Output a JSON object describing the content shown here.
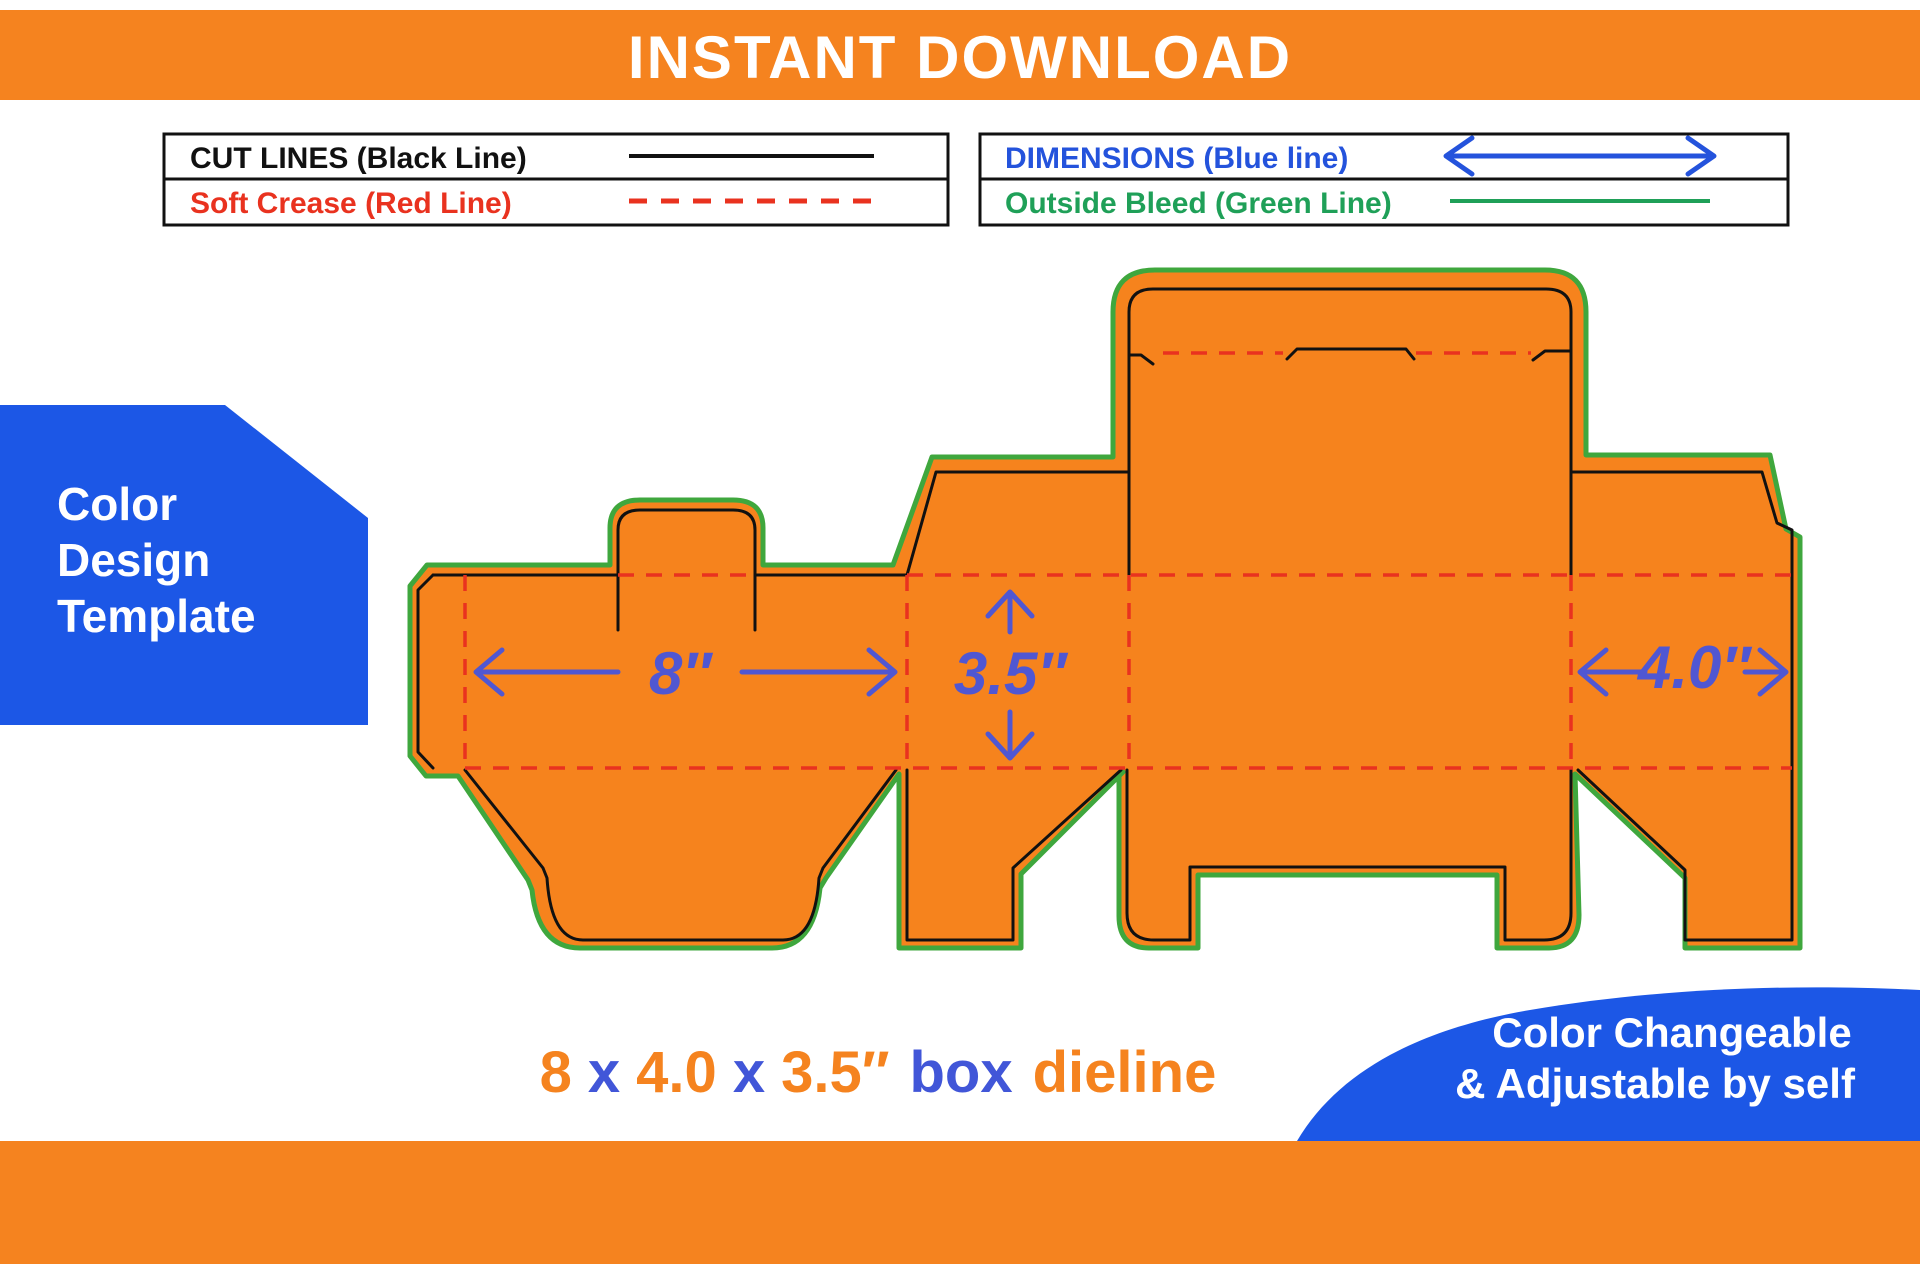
{
  "header": {
    "title": "INSTANT DOWNLOAD"
  },
  "legend": {
    "cut_lines": "CUT LINES (Black Line)",
    "soft_crease": "Soft Crease (Red Line)",
    "dimensions": "DIMENSIONS (Blue line)",
    "outside_bleed": "Outside Bleed (Green Line)"
  },
  "badge": {
    "line1": "Color",
    "line2": "Design",
    "line3": "Template"
  },
  "dieline": {
    "width_label": "8″",
    "height_label": "3.5″",
    "side_label": "4.0″"
  },
  "title": {
    "parts": [
      "8",
      "x",
      "4.0",
      "x",
      "3.5″",
      "box",
      "dieline"
    ]
  },
  "note": {
    "line1": "Color Changeable",
    "line2": "& Adjustable by self"
  },
  "colors": {
    "banner_orange": "#f5831f",
    "dieline_fill": "#f6831d",
    "bleed_green": "#3fa73d",
    "cut_black": "#111111",
    "crease_red": "#e9321f",
    "dimension_blue": "#5057d2",
    "badge_blue": "#1c57e6",
    "legend_blue": "#2453dc",
    "legend_green": "#1fa058",
    "title_blue": "#4156d8",
    "title_orange": "#f5831f"
  }
}
